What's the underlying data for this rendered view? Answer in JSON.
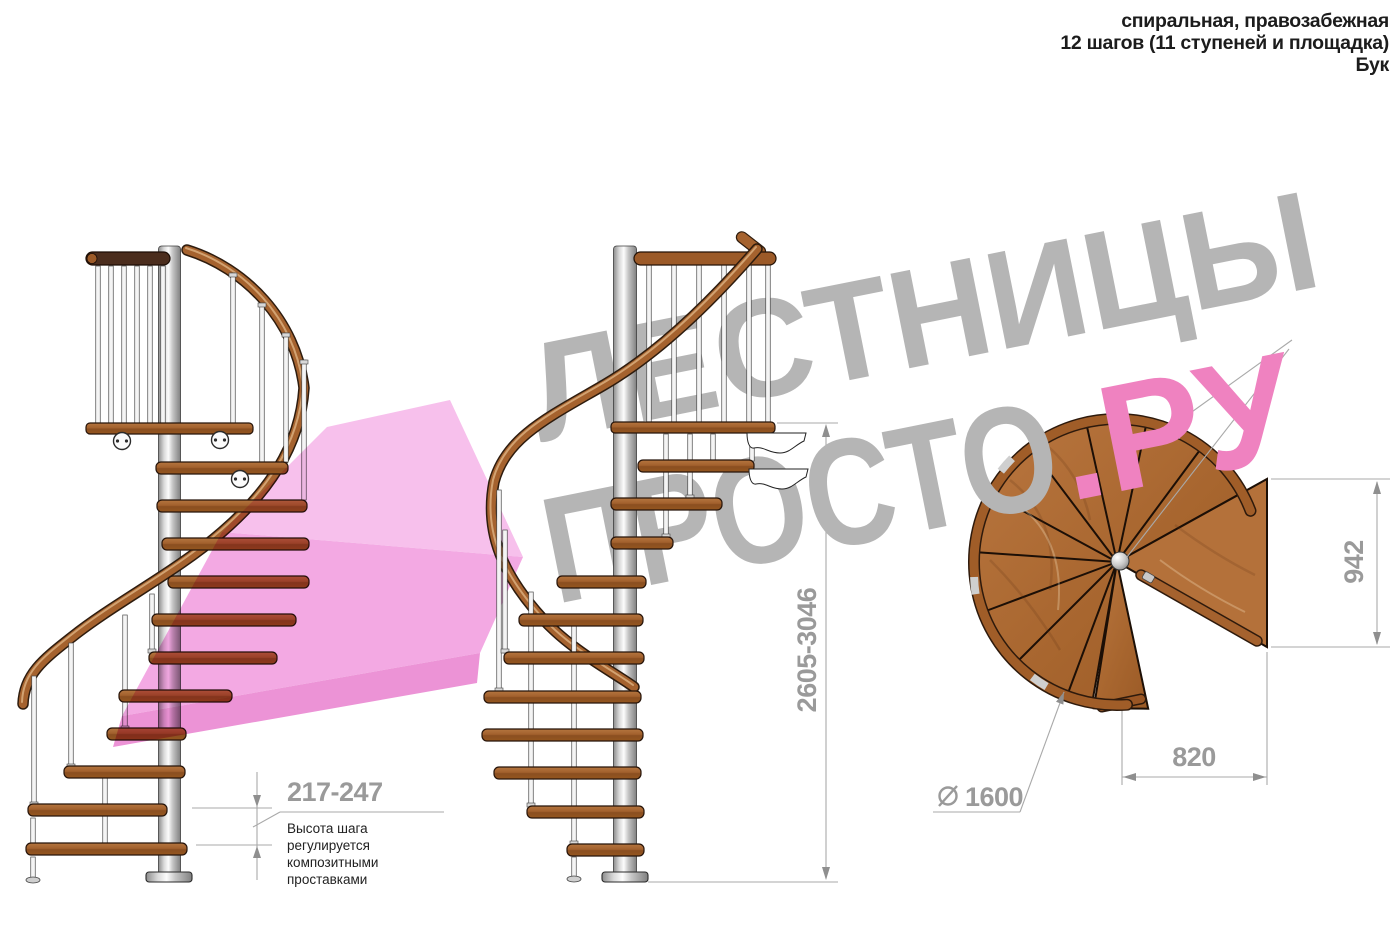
{
  "header": {
    "line1": "спиральная, правозабежная",
    "line2": "12 шагов (11 ступеней и площадка)",
    "line3": "Бук"
  },
  "watermark": {
    "line1": "ЛЕСТНИЦЫ",
    "line2_gray": "ПРОСТО",
    "line2_pink": ".РУ",
    "gray_color": "#b5b5b5",
    "pink_color": "#ef82c0"
  },
  "arrow": {
    "color": "#f1a0dd"
  },
  "dimensions": {
    "step_height": {
      "value": "217-247",
      "note_lines": [
        "Высота шага",
        "регулируется",
        "композитными",
        "проставками"
      ]
    },
    "total_height": {
      "value": "2605-3046"
    },
    "platform_depth": {
      "value": "942"
    },
    "platform_width": {
      "value": "820"
    },
    "diameter": {
      "value": "1600",
      "symbol_name": "diameter-symbol"
    }
  },
  "materials": {
    "wood": "#a5622e",
    "wood_dark": "#8a4e20",
    "rail_dark": "#4b2d1d",
    "metal": "#d9d9d9",
    "dimension_gray": "#9a9a9a"
  }
}
